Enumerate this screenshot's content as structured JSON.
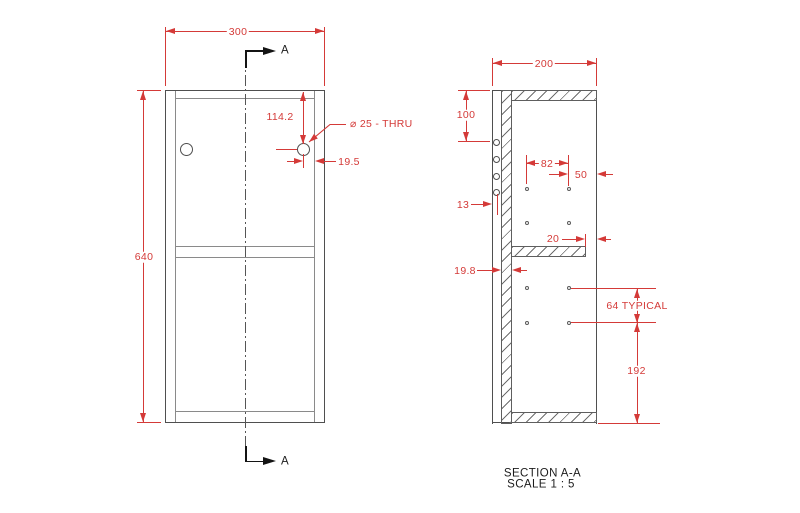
{
  "front_view": {
    "label_width": "300",
    "label_height": "640",
    "label_hole_offset_top": "114.2",
    "label_hole_offset_side": "19.5",
    "hole_callout": "⌀ 25 - THRU",
    "section_arrow_letter": "A"
  },
  "section_view": {
    "label_depth": "200",
    "label_first_hole": "100",
    "label_back_hole_offset": "13",
    "label_hole_columns_span": "82",
    "label_front_hole_offset": "50",
    "label_shelf_setback": "20",
    "label_panel_thickness": "19.8",
    "label_hole_pitch": "64 TYPICAL",
    "label_bottom_span": "192",
    "title": "SECTION A-A",
    "scale": "SCALE 1 : 5"
  },
  "colors": {
    "dimension_red": "#d43a38",
    "drawing_line": "#4f4f4f"
  }
}
